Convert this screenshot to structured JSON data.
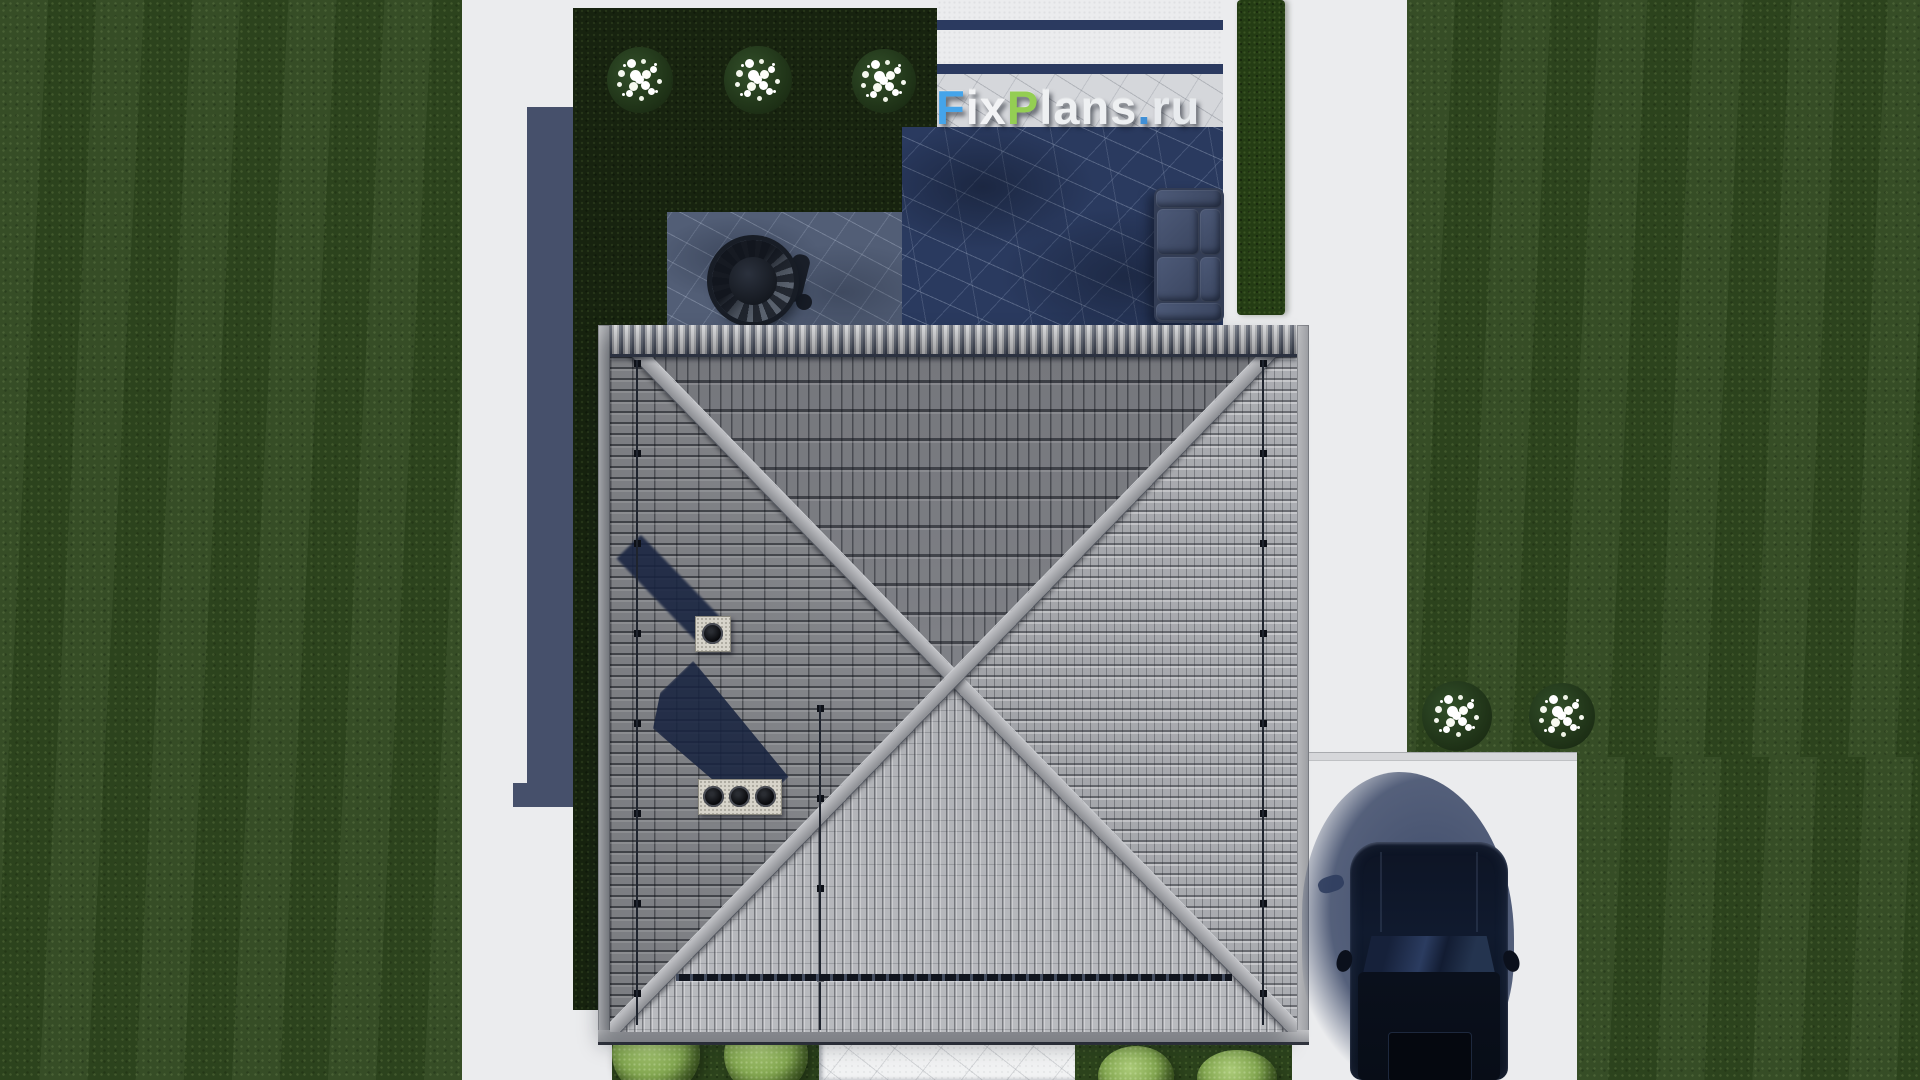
{
  "scene": {
    "title": "Top-down aerial 3D render of a house plot",
    "view": "orthographic top view",
    "features": {
      "roof": "square hip roof, four faces, X ridges, gray tiles",
      "chimneys": [
        {
          "flues": 1
        },
        {
          "flues": 3
        }
      ],
      "pool_terrace": "stone terrace with pool, hanging egg chair and outdoor sofa",
      "top_flower_bushes": 3,
      "right_flower_bushes": 2,
      "bottom_shrubs": 4,
      "car": "dark SUV parked on right driveway, top view"
    }
  },
  "watermark": {
    "text": "FixPlans.ru",
    "segments": [
      {
        "text": "F",
        "color": "#45a4ea"
      },
      {
        "text": "ix",
        "color": "#f2f3f5"
      },
      {
        "text": "P",
        "color": "#94ce53"
      },
      {
        "text": "lans",
        "color": "#eef0f2"
      },
      {
        "text": ".",
        "color": "#3f8fd6"
      },
      {
        "text": "ru",
        "color": "#e8ebee"
      }
    ]
  },
  "palette": {
    "lawn": "#2f471f",
    "garden_bed": "#17230f",
    "hedge": "#243c14",
    "path_concrete": "#ebecee",
    "walkway_marble": "#f1f2f3",
    "pool_water": "#2a3a5f",
    "terrace_stone": "#525e76",
    "shadow_navy": "#46506b",
    "roof_north": "#84868c",
    "roof_west": "#8a8c91",
    "roof_east": "#a2a4a9",
    "roof_south": "#aeb0b5",
    "ridge": "#b0b1b5",
    "chimney_stone": "#d7d4ca",
    "shrub_green": "#84a851",
    "flower_white": "#ffffff",
    "car_body": "#0d1424",
    "brand_blue": "#45a4ea",
    "brand_green": "#94ce53"
  }
}
